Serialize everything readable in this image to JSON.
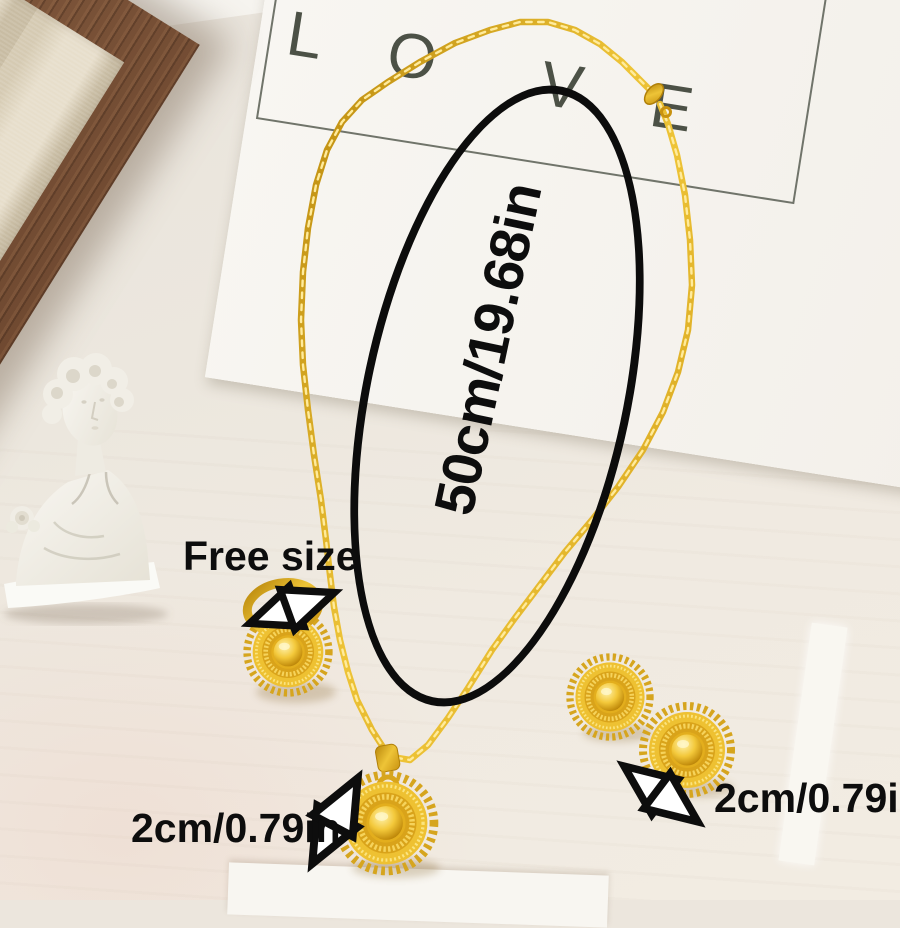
{
  "card": {
    "letters": [
      "L",
      "O",
      "V",
      "E"
    ]
  },
  "annotations": {
    "necklace_length": "50cm/19.68in",
    "ring_size_label": "Free size",
    "pendant_size": "2cm/0.79in",
    "earrings_size": "2cm/0.79in"
  },
  "icons": {
    "measure_arrow": "double-headed-measure-arrow",
    "measure_ellipse": "measurement-ellipse-outline"
  },
  "colors": {
    "gold": "#e3ae1d",
    "gold_light": "#fbe47f",
    "gold_dark": "#b8860b",
    "background": "#ece6dd",
    "card_white": "#f7f5f0",
    "wood_brown": "#6f4a32",
    "linen": "#ddd3bd",
    "statue_white": "#f3f1ea",
    "annotation_black": "#0d0d0d"
  }
}
